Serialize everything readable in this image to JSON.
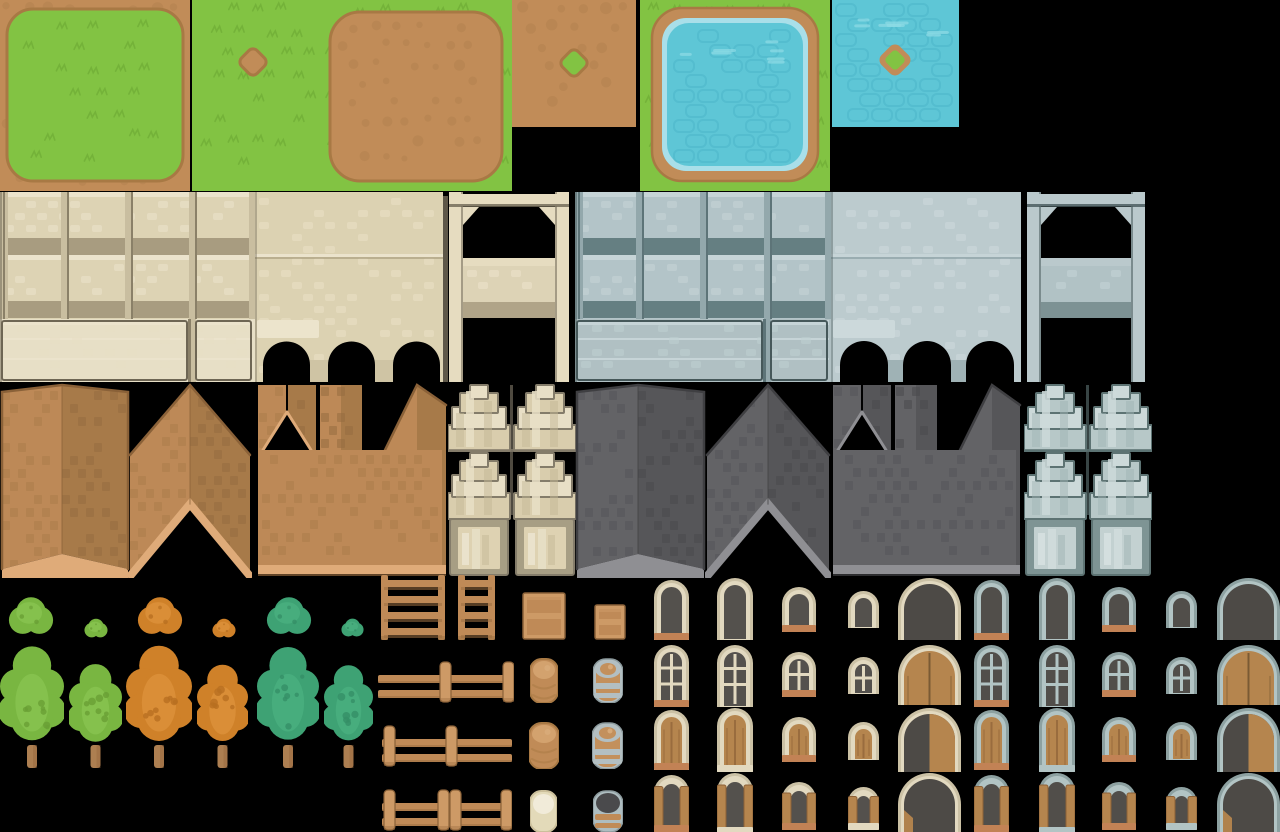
{
  "sheet": {
    "width": 1280,
    "height": 832,
    "background": "#000000",
    "label": "village-tileset-sheet"
  },
  "palette": {
    "terrain": {
      "grass": "#82c343",
      "grassTuft": "#72b039",
      "grassLight": "#8ecd52",
      "dirt": "#c18c58",
      "dirtDark": "#a87944",
      "pebble": "#b27f4d",
      "water": "#5ec6d6",
      "waterLine": "#4ab4c7",
      "waterLight": "#8fdbe6",
      "waterRim": "#a9dfe9"
    },
    "cream": {
      "body": "#ddd3b4",
      "top": "#ebe3cc",
      "dot": "#e7dec4",
      "band": "#a89c80",
      "div": "#c9bea0",
      "divDark": "#8a8068",
      "outline": "#6e6654",
      "plaster": "#e7dfc6",
      "smooth": "#dcd2b2",
      "smoothDot": "#e6dcbf",
      "ledge": "#a39878",
      "lightBlock": "#ece4cc",
      "pier": "#cfc4a4",
      "pillar": "#e6dcc0",
      "beamShadow": "#6e6654",
      "mid": "#ddd3b6",
      "midDot": "#e8dfc6",
      "shadow": "#b0a488",
      "darkPost": "#5e5748"
    },
    "gray": {
      "body": "#b3c4c8",
      "top": "#c6d4d7",
      "dot": "#c0cfd2",
      "band": "#657f82",
      "div": "#93a8ac",
      "divDark": "#5d7478",
      "outline": "#46585a",
      "plaster": "#b0c0c3",
      "smooth": "#bccbce",
      "smoothDot": "#c8d5d8",
      "ledge": "#849a9e",
      "lightBlock": "#ccd9db",
      "pier": "#9fb2b5",
      "pillar": "#bac9cc",
      "beamShadow": "#46585a",
      "mid": "#b1c2c5",
      "midDot": "#bfced1",
      "shadow": "#7d9294",
      "darkPost": "#3c4c4e"
    },
    "brown": {
      "faceL": "#bd8957",
      "faceR": "#a77a49",
      "dotL": "#ab7c4a",
      "dotR": "#966c3f",
      "eave": "#dfab79",
      "edge": "#8a6138"
    },
    "grayRoof": {
      "faceL": "#636366",
      "faceR": "#565659",
      "dotL": "#565659",
      "dotR": "#4a4a4d",
      "eave": "#8f8f93",
      "edge": "#3f3f42"
    },
    "creamBay": {
      "light": "#e8dfc6",
      "mid": "#d9cdad",
      "shade": "#c4b795",
      "dark": "#847c6a",
      "frame": "#a79e84",
      "panel": "#ded2b2",
      "stripe": "#eae2cc"
    },
    "grayBay": {
      "light": "#ccd9d9",
      "mid": "#b7c8c8",
      "shade": "#9fb4b4",
      "dark": "#5d7373",
      "frame": "#7e9494",
      "panel": "#c3d1d1",
      "stripe": "#d4dfdf"
    },
    "green": {
      "base": "#79b641",
      "light": "#86c24f",
      "dark": "#699f35",
      "trunk": "#ad7f51",
      "trunkDark": "#96693f"
    },
    "orange": {
      "base": "#cf8129",
      "light": "#da8f38",
      "dark": "#b86f20",
      "trunk": "#ad7f51",
      "trunkDark": "#96693f"
    },
    "teal": {
      "base": "#3ea274",
      "light": "#48ae7e",
      "dark": "#358f67",
      "trunk": "#ad7f51",
      "trunkDark": "#96693f"
    },
    "wood": {
      "base": "#bf8a57",
      "light": "#cd9a66",
      "dark": "#8a6138",
      "shadow": "#9c6f42"
    },
    "barrels": {
      "brown": {
        "body": "#c08b57",
        "top": "#d3a26e",
        "line": "#a87944",
        "hi": "#d8ab79"
      },
      "ringed": {
        "body": "#c3905c",
        "ring": "#b3bfc2",
        "ringDark": "#8c9a9d",
        "hi": "#d8ab79"
      },
      "cream": {
        "body": "#e3dab9",
        "top": "#f1ebd9",
        "line": "#cbbf9b"
      },
      "open": {
        "rim": "#aebdc0",
        "rimDark": "#8c9a9d",
        "hole": "#4a4a4c",
        "band": "#c08b57"
      }
    },
    "creamWin": {
      "frameOuter": "#cbc1a5",
      "frameInner": "#e2d9c0",
      "glass": "#54514d",
      "sillOrange": "#c28255",
      "shutter": "#b5854e",
      "shutterDark": "#8d6137",
      "door": "#b5854e",
      "doorDark": "#4d4a46"
    },
    "grayWin": {
      "frameOuter": "#8da1a1",
      "frameInner": "#b2c4c4",
      "glass": "#514e4a",
      "sillOrange": "#c28255",
      "shutter": "#b5854e",
      "shutterDark": "#8d6137",
      "door": "#b5854e",
      "doorDark": "#4d4a46"
    }
  },
  "tiles": [
    {
      "name": "grass-island-tile",
      "kind": "grassIsland",
      "x": 0,
      "y": 0,
      "w": 190,
      "h": 191
    },
    {
      "name": "grass-dirt-spot-tile",
      "kind": "grassSpot",
      "x": 192,
      "y": 0,
      "w": 128,
      "h": 191
    },
    {
      "name": "dirt-patch-on-grass-tile",
      "kind": "dirtPatch",
      "x": 320,
      "y": 0,
      "w": 192,
      "h": 191
    },
    {
      "name": "dirt-grass-spot-tile",
      "kind": "dirtSpot",
      "x": 512,
      "y": 0,
      "w": 124,
      "h": 127
    },
    {
      "name": "pond-tile",
      "kind": "pond",
      "x": 640,
      "y": 0,
      "w": 190,
      "h": 191
    },
    {
      "name": "water-island-tile",
      "kind": "waterSpot",
      "x": 832,
      "y": 0,
      "w": 127,
      "h": 127
    },
    {
      "name": "cream-wall-panels-tile",
      "kind": "wallPanels",
      "v": "cream",
      "x": 0,
      "y": 192,
      "w": 255,
      "h": 190
    },
    {
      "name": "cream-wall-arches-tile",
      "kind": "wallArches",
      "v": "cream",
      "x": 255,
      "y": 192,
      "w": 188,
      "h": 190
    },
    {
      "name": "cream-wall-gate-tile",
      "kind": "wallGate",
      "v": "cream",
      "x": 443,
      "y": 192,
      "w": 132,
      "h": 190
    },
    {
      "name": "gray-wall-panels-tile",
      "kind": "wallPanels",
      "v": "gray",
      "x": 575,
      "y": 192,
      "w": 256,
      "h": 190
    },
    {
      "name": "gray-wall-arches-tile",
      "kind": "wallArches",
      "v": "gray",
      "x": 831,
      "y": 192,
      "w": 190,
      "h": 190
    },
    {
      "name": "gray-wall-gate-tile",
      "kind": "wallGate",
      "v": "gray",
      "x": 1021,
      "y": 192,
      "w": 130,
      "h": 190
    },
    {
      "name": "brown-roof-tower-tile",
      "kind": "roofTower",
      "v": "brown",
      "x": 0,
      "y": 383,
      "w": 130,
      "h": 195
    },
    {
      "name": "brown-roof-chevron-tile",
      "kind": "roofChevron",
      "v": "brown",
      "x": 128,
      "y": 383,
      "w": 124,
      "h": 195
    },
    {
      "name": "brown-roof-castle-tile",
      "kind": "roofCastle",
      "v": "brown",
      "x": 256,
      "y": 383,
      "w": 192,
      "h": 195
    },
    {
      "name": "cream-bay-facade-tile",
      "kind": "bayFacade",
      "v": "creamBay",
      "x": 448,
      "y": 383,
      "w": 128,
      "h": 195
    },
    {
      "name": "gray-roof-tower-tile",
      "kind": "roofTower",
      "v": "grayRoof",
      "x": 575,
      "y": 383,
      "w": 131,
      "h": 195
    },
    {
      "name": "gray-roof-chevron-tile",
      "kind": "roofChevron",
      "v": "grayRoof",
      "x": 705,
      "y": 383,
      "w": 126,
      "h": 195
    },
    {
      "name": "gray-roof-castle-tile",
      "kind": "roofCastle",
      "v": "grayRoof",
      "x": 831,
      "y": 383,
      "w": 191,
      "h": 195
    },
    {
      "name": "gray-bay-facade-tile",
      "kind": "bayFacade",
      "v": "grayBay",
      "x": 1024,
      "y": 383,
      "w": 128,
      "h": 195
    },
    {
      "name": "green-bush-large-sprite",
      "kind": "bush",
      "v": "green",
      "x": 8,
      "y": 594,
      "w": 46,
      "h": 45
    },
    {
      "name": "green-bush-small-sprite",
      "kind": "bush",
      "v": "green",
      "x": 84,
      "y": 618,
      "w": 24,
      "h": 21
    },
    {
      "name": "orange-bush-large-sprite",
      "kind": "bush",
      "v": "orange",
      "x": 137,
      "y": 594,
      "w": 46,
      "h": 45
    },
    {
      "name": "orange-bush-small-sprite",
      "kind": "bush",
      "v": "orange",
      "x": 212,
      "y": 618,
      "w": 24,
      "h": 21
    },
    {
      "name": "teal-bush-large-sprite",
      "kind": "bush",
      "v": "teal",
      "x": 266,
      "y": 594,
      "w": 46,
      "h": 45
    },
    {
      "name": "teal-bush-small-sprite",
      "kind": "bush",
      "v": "teal",
      "x": 341,
      "y": 618,
      "w": 23,
      "h": 20
    },
    {
      "name": "green-tree-large-sprite",
      "kind": "tree",
      "v": "green",
      "x": 0,
      "y": 645,
      "w": 64,
      "h": 123
    },
    {
      "name": "green-tree-small-sprite",
      "kind": "tree",
      "v": "green",
      "x": 69,
      "y": 663,
      "w": 53,
      "h": 105
    },
    {
      "name": "orange-tree-large-sprite",
      "kind": "tree",
      "v": "orange",
      "x": 126,
      "y": 645,
      "w": 66,
      "h": 123
    },
    {
      "name": "orange-tree-small-sprite",
      "kind": "tree",
      "v": "orange",
      "x": 197,
      "y": 663,
      "w": 51,
      "h": 105
    },
    {
      "name": "teal-tree-large-sprite",
      "kind": "tree",
      "v": "teal",
      "x": 257,
      "y": 645,
      "w": 62,
      "h": 123
    },
    {
      "name": "teal-tree-small-sprite",
      "kind": "tree",
      "v": "teal",
      "x": 324,
      "y": 663,
      "w": 49,
      "h": 105
    },
    {
      "name": "ladder-wide-sprite",
      "kind": "ladder",
      "x": 380,
      "y": 575,
      "w": 66,
      "h": 65
    },
    {
      "name": "ladder-narrow-sprite",
      "kind": "ladder",
      "x": 457,
      "y": 575,
      "w": 39,
      "h": 65
    },
    {
      "name": "crate-large-sprite",
      "kind": "crate",
      "x": 522,
      "y": 592,
      "w": 44,
      "h": 48
    },
    {
      "name": "crate-small-sprite",
      "kind": "crate",
      "x": 594,
      "y": 604,
      "w": 32,
      "h": 36
    },
    {
      "name": "fence-right-posts-sprite",
      "kind": "fence",
      "x": 378,
      "y": 660,
      "w": 136,
      "h": 43,
      "posts": [
        62,
        125
      ]
    },
    {
      "name": "fence-left-posts-sprite",
      "kind": "fence",
      "x": 382,
      "y": 724,
      "w": 130,
      "h": 44,
      "posts": [
        2,
        64
      ]
    },
    {
      "name": "fence-double-post-sprite",
      "kind": "fence",
      "x": 382,
      "y": 788,
      "w": 130,
      "h": 44,
      "posts": [
        2,
        56,
        68,
        119
      ]
    },
    {
      "name": "barrel-brown-sprite",
      "kind": "barrel",
      "v": "brown",
      "x": 530,
      "y": 657,
      "w": 28,
      "h": 46
    },
    {
      "name": "barrel-iron-band-sprite",
      "kind": "barrel",
      "v": "ringed",
      "x": 593,
      "y": 657,
      "w": 30,
      "h": 46
    },
    {
      "name": "barrel-brown-tall-sprite",
      "kind": "barrel",
      "v": "brown",
      "x": 529,
      "y": 721,
      "w": 30,
      "h": 48
    },
    {
      "name": "barrel-iron-tall-sprite",
      "kind": "barrel",
      "v": "ringed",
      "x": 592,
      "y": 721,
      "w": 31,
      "h": 48
    },
    {
      "name": "barrel-cream-sprite",
      "kind": "barrel",
      "v": "cream",
      "x": 530,
      "y": 789,
      "w": 27,
      "h": 43
    },
    {
      "name": "barrel-open-sprite",
      "kind": "barrel",
      "v": "open",
      "x": 593,
      "y": 789,
      "w": 30,
      "h": 43
    },
    {
      "name": "cream-window-tall-sill",
      "kind": "archWindow",
      "v": "creamWin",
      "variant": "plain",
      "sill": "orange",
      "x": 654,
      "y": 580,
      "w": 35,
      "h": 60
    },
    {
      "name": "cream-window-tall",
      "kind": "archWindow",
      "v": "creamWin",
      "variant": "plain",
      "sill": "none",
      "x": 717,
      "y": 578,
      "w": 36,
      "h": 62
    },
    {
      "name": "cream-window-mid-sill",
      "kind": "archWindow",
      "v": "creamWin",
      "variant": "plain",
      "sill": "orange",
      "x": 782,
      "y": 587,
      "w": 34,
      "h": 45
    },
    {
      "name": "cream-window-small",
      "kind": "archWindow",
      "v": "creamWin",
      "variant": "plain",
      "sill": "none",
      "x": 848,
      "y": 591,
      "w": 31,
      "h": 37
    },
    {
      "name": "cream-archway-dark",
      "kind": "archDoor",
      "v": "creamWin",
      "variant": "dark",
      "x": 898,
      "y": 578,
      "w": 63,
      "h": 62
    },
    {
      "name": "cream-window-pane-sill",
      "kind": "archWindow",
      "v": "creamWin",
      "variant": "muntin",
      "sill": "orange",
      "x": 654,
      "y": 645,
      "w": 35,
      "h": 62
    },
    {
      "name": "cream-window-pane-tall",
      "kind": "archWindow",
      "v": "creamWin",
      "variant": "muntin",
      "sill": "none",
      "x": 717,
      "y": 645,
      "w": 36,
      "h": 62
    },
    {
      "name": "cream-window-pane-mid",
      "kind": "archWindow",
      "v": "creamWin",
      "variant": "muntin",
      "sill": "orange",
      "x": 782,
      "y": 652,
      "w": 34,
      "h": 45
    },
    {
      "name": "cream-window-pane-small",
      "kind": "archWindow",
      "v": "creamWin",
      "variant": "muntin",
      "sill": "none",
      "x": 848,
      "y": 657,
      "w": 31,
      "h": 37
    },
    {
      "name": "cream-door-double",
      "kind": "archDoor",
      "v": "creamWin",
      "variant": "double",
      "x": 898,
      "y": 645,
      "w": 63,
      "h": 60
    },
    {
      "name": "cream-window-shut-sill",
      "kind": "archWindow",
      "v": "creamWin",
      "variant": "shutter",
      "sill": "orange",
      "x": 654,
      "y": 710,
      "w": 35,
      "h": 60
    },
    {
      "name": "cream-window-shut-tall",
      "kind": "archWindow",
      "v": "creamWin",
      "variant": "shutter",
      "sill": "cream",
      "x": 717,
      "y": 708,
      "w": 36,
      "h": 64
    },
    {
      "name": "cream-window-shut-mid",
      "kind": "archWindow",
      "v": "creamWin",
      "variant": "shutter",
      "sill": "orange",
      "x": 782,
      "y": 717,
      "w": 34,
      "h": 45
    },
    {
      "name": "cream-window-shut-small",
      "kind": "archWindow",
      "v": "creamWin",
      "variant": "shutter",
      "sill": "none",
      "x": 848,
      "y": 722,
      "w": 31,
      "h": 38
    },
    {
      "name": "cream-door-half-open",
      "kind": "archDoor",
      "v": "creamWin",
      "variant": "half",
      "x": 898,
      "y": 708,
      "w": 63,
      "h": 64
    },
    {
      "name": "cream-window-open-sill",
      "kind": "archWindow",
      "v": "creamWin",
      "variant": "open",
      "sill": "orange",
      "x": 654,
      "y": 775,
      "w": 35,
      "h": 57
    },
    {
      "name": "cream-window-open-tall",
      "kind": "archWindow",
      "v": "creamWin",
      "variant": "open",
      "sill": "cream",
      "x": 717,
      "y": 773,
      "w": 36,
      "h": 61
    },
    {
      "name": "cream-window-open-mid",
      "kind": "archWindow",
      "v": "creamWin",
      "variant": "open",
      "sill": "orange",
      "x": 782,
      "y": 782,
      "w": 34,
      "h": 48
    },
    {
      "name": "cream-window-open-small",
      "kind": "archWindow",
      "v": "creamWin",
      "variant": "open",
      "sill": "cream",
      "x": 848,
      "y": 787,
      "w": 31,
      "h": 43
    },
    {
      "name": "cream-door-open",
      "kind": "archDoor",
      "v": "creamWin",
      "variant": "open",
      "x": 898,
      "y": 773,
      "w": 63,
      "h": 59
    },
    {
      "name": "gray-window-tall-sill",
      "kind": "archWindow",
      "v": "grayWin",
      "variant": "plain",
      "sill": "orange",
      "x": 974,
      "y": 580,
      "w": 35,
      "h": 60
    },
    {
      "name": "gray-window-tall",
      "kind": "archWindow",
      "v": "grayWin",
      "variant": "plain",
      "sill": "none",
      "x": 1039,
      "y": 578,
      "w": 36,
      "h": 62
    },
    {
      "name": "gray-window-mid-sill",
      "kind": "archWindow",
      "v": "grayWin",
      "variant": "plain",
      "sill": "orange",
      "x": 1102,
      "y": 587,
      "w": 34,
      "h": 45
    },
    {
      "name": "gray-window-small",
      "kind": "archWindow",
      "v": "grayWin",
      "variant": "plain",
      "sill": "none",
      "x": 1166,
      "y": 591,
      "w": 31,
      "h": 37
    },
    {
      "name": "gray-archway-dark",
      "kind": "archDoor",
      "v": "grayWin",
      "variant": "dark",
      "x": 1217,
      "y": 578,
      "w": 63,
      "h": 62
    },
    {
      "name": "gray-window-pane-sill",
      "kind": "archWindow",
      "v": "grayWin",
      "variant": "muntin",
      "sill": "orange",
      "x": 974,
      "y": 645,
      "w": 35,
      "h": 62
    },
    {
      "name": "gray-window-pane-tall",
      "kind": "archWindow",
      "v": "grayWin",
      "variant": "muntin",
      "sill": "none",
      "x": 1039,
      "y": 645,
      "w": 36,
      "h": 62
    },
    {
      "name": "gray-window-pane-mid",
      "kind": "archWindow",
      "v": "grayWin",
      "variant": "muntin",
      "sill": "orange",
      "x": 1102,
      "y": 652,
      "w": 34,
      "h": 45
    },
    {
      "name": "gray-window-pane-small",
      "kind": "archWindow",
      "v": "grayWin",
      "variant": "muntin",
      "sill": "none",
      "x": 1166,
      "y": 657,
      "w": 31,
      "h": 37
    },
    {
      "name": "gray-door-double",
      "kind": "archDoor",
      "v": "grayWin",
      "variant": "double",
      "x": 1217,
      "y": 645,
      "w": 63,
      "h": 60
    },
    {
      "name": "gray-window-shut-sill",
      "kind": "archWindow",
      "v": "grayWin",
      "variant": "shutter",
      "sill": "orange",
      "x": 974,
      "y": 710,
      "w": 35,
      "h": 60
    },
    {
      "name": "gray-window-shut-tall",
      "kind": "archWindow",
      "v": "grayWin",
      "variant": "shutter",
      "sill": "cream",
      "x": 1039,
      "y": 708,
      "w": 36,
      "h": 64
    },
    {
      "name": "gray-window-shut-mid",
      "kind": "archWindow",
      "v": "grayWin",
      "variant": "shutter",
      "sill": "orange",
      "x": 1102,
      "y": 717,
      "w": 34,
      "h": 45
    },
    {
      "name": "gray-window-shut-small",
      "kind": "archWindow",
      "v": "grayWin",
      "variant": "shutter",
      "sill": "none",
      "x": 1166,
      "y": 722,
      "w": 31,
      "h": 38
    },
    {
      "name": "gray-door-half-open",
      "kind": "archDoor",
      "v": "grayWin",
      "variant": "half",
      "x": 1217,
      "y": 708,
      "w": 63,
      "h": 64
    },
    {
      "name": "gray-window-open-sill",
      "kind": "archWindow",
      "v": "grayWin",
      "variant": "open",
      "sill": "orange",
      "x": 974,
      "y": 775,
      "w": 35,
      "h": 57
    },
    {
      "name": "gray-window-open-tall",
      "kind": "archWindow",
      "v": "grayWin",
      "variant": "open",
      "sill": "cream",
      "x": 1039,
      "y": 773,
      "w": 36,
      "h": 61
    },
    {
      "name": "gray-window-open-mid",
      "kind": "archWindow",
      "v": "grayWin",
      "variant": "open",
      "sill": "orange",
      "x": 1102,
      "y": 782,
      "w": 34,
      "h": 48
    },
    {
      "name": "gray-window-open-small",
      "kind": "archWindow",
      "v": "grayWin",
      "variant": "open",
      "sill": "cream",
      "x": 1166,
      "y": 787,
      "w": 31,
      "h": 43
    },
    {
      "name": "gray-door-open",
      "kind": "archDoor",
      "v": "grayWin",
      "variant": "open",
      "x": 1217,
      "y": 773,
      "w": 63,
      "h": 59
    }
  ]
}
